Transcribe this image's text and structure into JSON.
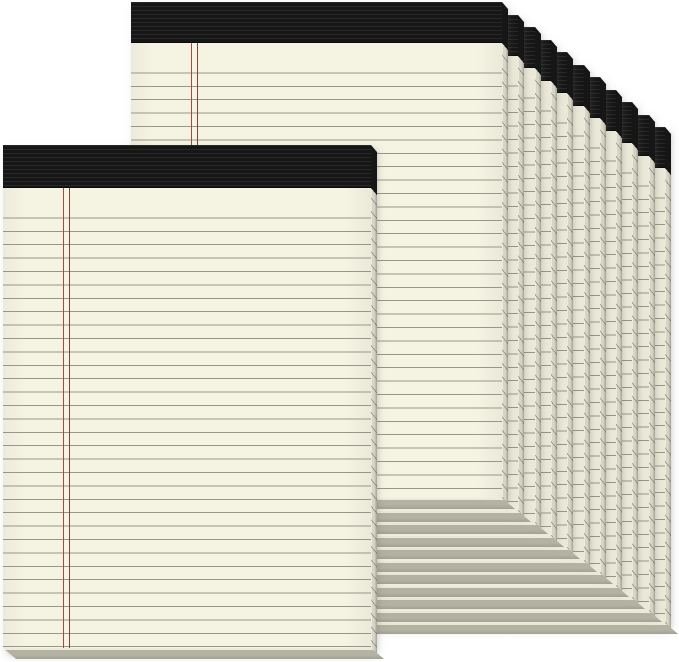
{
  "scene": {
    "description": "Product photo of a 12-pack of ivory ruled legal writing pads with black tape bindings: two pads staggered in front, ten pads fanned diagonally behind toward the upper right",
    "background_color": "#ffffff",
    "visible_pad_count": 12,
    "text_content": "none"
  },
  "pad": {
    "paper_color": "#f5f3e2",
    "rule_line_color": "#98968a",
    "margin_line_light_color": "#a04c42",
    "margin_line_dark_color": "#7b443c",
    "binding_color": "#161616",
    "edge_highlight_color": "#ecead9",
    "edge_mid_color": "#d7d5c6",
    "edge_shadow_color": "#a3a194",
    "bottom_edge_color": "#b4b2a3",
    "rule_spacing_px": 13.4,
    "first_rule_offset_px": 17,
    "margin_line_left_px": 60,
    "side_edge_width_px": 6,
    "bottom_edge_height_px": 11
  },
  "layout": {
    "canvas": {
      "width": 679,
      "height": 662
    },
    "back_pad": {
      "x": 131,
      "y": 2,
      "width": 371,
      "height": 496,
      "binding_height": 41
    },
    "front_pad": {
      "x": 3,
      "y": 145,
      "width": 368,
      "height": 503,
      "binding_height": 43
    },
    "fan": {
      "count": 10,
      "offset_x": 16.3,
      "offset_y": 12.5
    }
  }
}
